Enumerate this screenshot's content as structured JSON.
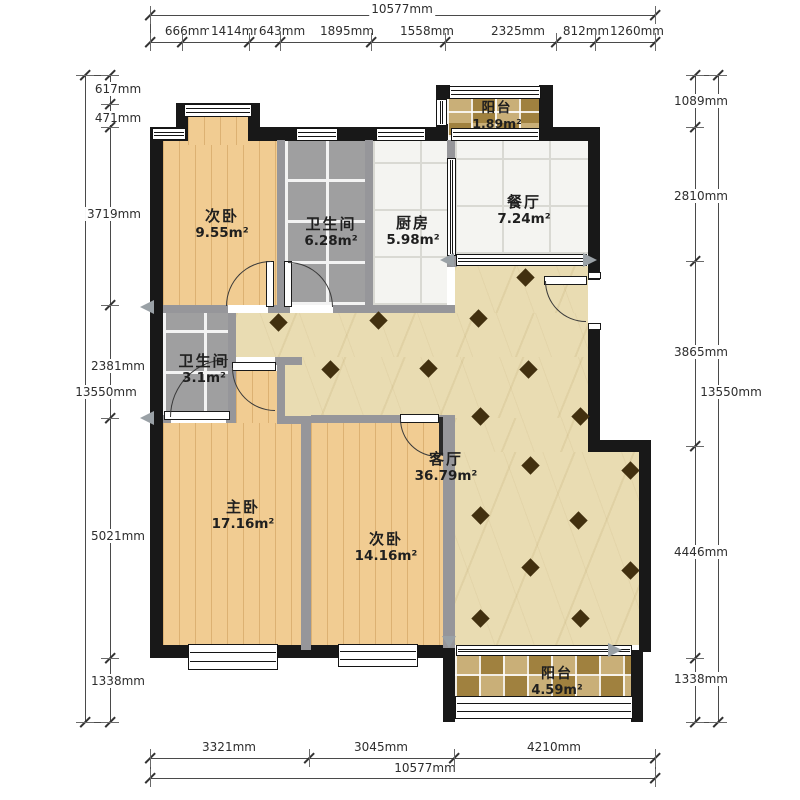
{
  "plan": {
    "rooms": [
      {
        "id": "bedroom-top",
        "name": "次卧",
        "area": "9.55m²"
      },
      {
        "id": "bath-main",
        "name": "卫生间",
        "area": "6.28m²"
      },
      {
        "id": "kitchen",
        "name": "厨房",
        "area": "5.98m²"
      },
      {
        "id": "dining",
        "name": "餐厅",
        "area": "7.24m²"
      },
      {
        "id": "balcony-top",
        "name": "阳台",
        "area": "1.89m²"
      },
      {
        "id": "bath-small",
        "name": "卫生间",
        "area": "3.1m²"
      },
      {
        "id": "living",
        "name": "客厅",
        "area": "36.79m²"
      },
      {
        "id": "master",
        "name": "主卧",
        "area": "17.16m²"
      },
      {
        "id": "bedroom2",
        "name": "次卧",
        "area": "14.16m²"
      },
      {
        "id": "balcony-bottom",
        "name": "阳台",
        "area": "4.59m²"
      }
    ]
  },
  "dimensions": {
    "top_total": "10577mm",
    "top": [
      "666mm",
      "1414mm",
      "643mm",
      "1895mm",
      "1558mm",
      "2325mm",
      "812mm",
      "1260mm"
    ],
    "bottom": [
      "3321mm",
      "3045mm",
      "4210mm"
    ],
    "bottom_total": "10577mm",
    "left_total": "13550mm",
    "left": [
      "617mm",
      "471mm",
      "3719mm",
      "2381mm",
      "5021mm",
      "1338mm"
    ],
    "right": [
      "1089mm",
      "2810mm",
      "3865mm",
      "4446mm",
      "1338mm"
    ],
    "right_total": "13550mm"
  },
  "colors": {
    "exterior_wall": "#181818",
    "interior_wall": "#96969a",
    "wood_floor": "#f1cc92",
    "gray_tile": "#9f9fa0",
    "white_tile": "#f4f4f1",
    "marble_beige": "#e9dcb2",
    "mosaic_brown": "#b79a5e",
    "diamond_accent": "#42300f",
    "arrow_gray": "#9aa1a6"
  },
  "decor": {
    "diamond_positions": [
      [
        278,
        322
      ],
      [
        378,
        320
      ],
      [
        478,
        318
      ],
      [
        525,
        277
      ],
      [
        330,
        369
      ],
      [
        428,
        368
      ],
      [
        528,
        369
      ],
      [
        480,
        416
      ],
      [
        580,
        416
      ],
      [
        530,
        465
      ],
      [
        630,
        470
      ],
      [
        480,
        515
      ],
      [
        578,
        520
      ],
      [
        530,
        567
      ],
      [
        630,
        570
      ],
      [
        480,
        618
      ],
      [
        580,
        618
      ]
    ]
  }
}
